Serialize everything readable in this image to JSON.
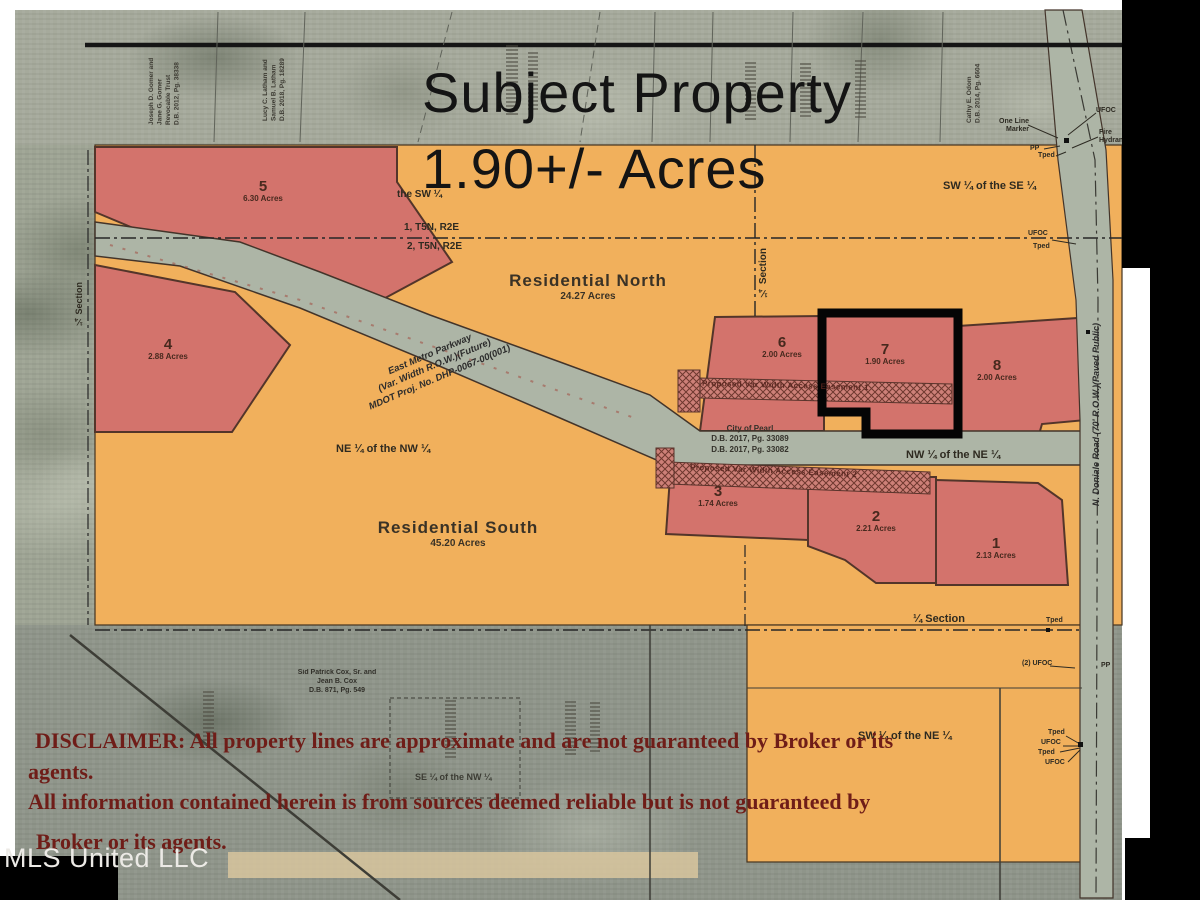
{
  "title": {
    "heading": "Subject Property",
    "acreage": "1.90+/- Acres"
  },
  "watermark": "MLS United LLC",
  "disclaimer": {
    "line1": "DISCLAIMER: All property lines are approximate and are not guaranteed by Broker or its",
    "line2": "agents.",
    "line3": "All information contained herein is from sources deemed reliable but is not guaranteed by",
    "line4": "Broker or its agents."
  },
  "tracts": {
    "residential_north": {
      "name": "Residential North",
      "acres": "24.27 Acres"
    },
    "residential_south": {
      "name": "Residential South",
      "acres": "45.20 Acres"
    }
  },
  "parcels": {
    "p1": {
      "num": "1",
      "acres": "2.13 Acres"
    },
    "p2": {
      "num": "2",
      "acres": "2.21 Acres"
    },
    "p3": {
      "num": "3",
      "acres": "1.74 Acres"
    },
    "p4": {
      "num": "4",
      "acres": "2.88 Acres"
    },
    "p5": {
      "num": "5",
      "acres": "6.30 Acres"
    },
    "p6": {
      "num": "6",
      "acres": "2.00 Acres"
    },
    "p7": {
      "num": "7",
      "acres": "1.90 Acres"
    },
    "p8": {
      "num": "8",
      "acres": "2.00 Acres"
    }
  },
  "quarter_labels": {
    "the_sw": "the SW ¼",
    "sw_of_se": "SW ¼ of the SE ¼",
    "ne_of_nw": "NE ¼ of the NW ¼",
    "nw_of_ne": "NW ¼ of the NE ¼",
    "sw_of_ne": "SW ¼ of the NE ¼",
    "se_of_nw": "SE ¼ of the NW ¼"
  },
  "section_lines": {
    "township_above": "1, T5N, R2E",
    "township_below": "2, T5N, R2E",
    "quarter_section": "¼ Section",
    "quarter_section_left": "¼ Section",
    "quarter_section_mid": "¼ Section"
  },
  "roads": {
    "east_metro_parkway": "East Metro Parkway\n(Var. Width R.O.W.)(Future)\nMDOT Proj. No. DHP-0067-00(001)",
    "side_road": "N. Doniale Road (70' R.O.W.)(Paved Public)"
  },
  "easements": {
    "easement1": "Proposed Var Width Access Easement 1",
    "easement2": "Proposed Var Width Access Easement 2"
  },
  "annotations": {
    "city_of_pearl": "City of Pearl\nD.B. 2017, Pg. 33089\nD.B. 2017, Pg. 33082",
    "owner_gomer": "Joseph D. Gomer and\nJane G. Gomer\nRevocable Trust\nD.B. 2012, Pg. 38338",
    "owner_latham": "Lucy C. Latham and\nSamuel B. Latham\nD.B. 2018, Pg. 18289",
    "owner_odom": "Cathy E. Odom\nD.B. 2014, Pg. 6604",
    "owner_cox": "Sid Patrick Cox, Sr. and\nJean B. Cox\nD.B. 871, Pg. 549"
  },
  "markers": {
    "ufoc": "UFOC",
    "ufoc2": "(2) UFOC",
    "tped": "Tped",
    "pp": "PP",
    "fire_hydrant": "Fire\nHydrant",
    "one_line_marker": "One Line\nMarker"
  },
  "colors": {
    "orange": "#f1b05c",
    "parcel_red": "#d3736c",
    "road_gray": "#a9b2a3",
    "photo_gray": "#9aa093",
    "line_brown": "#44331f",
    "disclaimer_red": "#6f1d18",
    "subject_outline": "#050505"
  }
}
